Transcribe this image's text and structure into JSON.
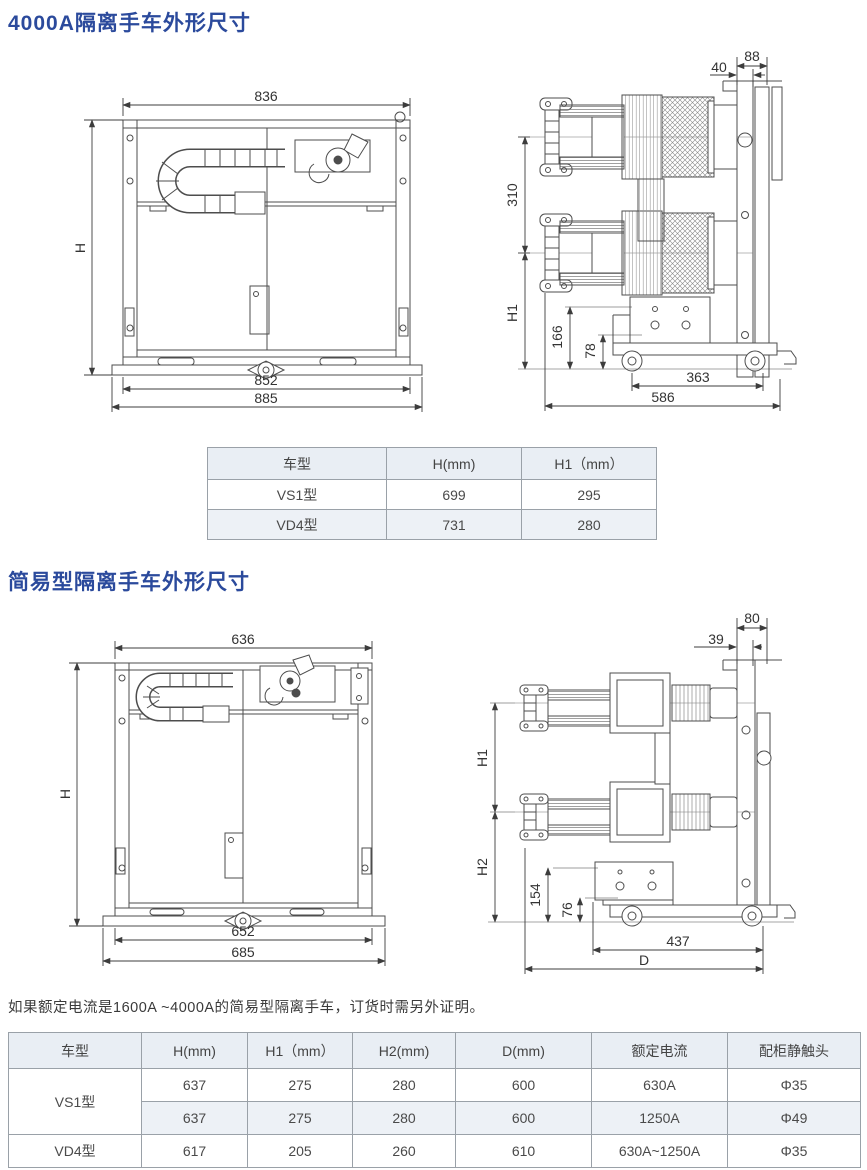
{
  "section1": {
    "title": "4000A隔离手车外形尺寸"
  },
  "section2": {
    "title": "简易型隔离手车外形尺寸"
  },
  "note": "如果额定电流是1600A ~4000A的简易型隔离手车，订货时需另外证明。",
  "fig1": {
    "top": "836",
    "left": "H",
    "b1": "852",
    "b2": "885"
  },
  "fig2": {
    "t1": "40",
    "t2": "88",
    "l1": "310",
    "l2": "H1",
    "l3": "166",
    "l4": "78",
    "b1": "363",
    "b2": "586"
  },
  "fig3": {
    "top": "636",
    "left": "H",
    "b1": "652",
    "b2": "685"
  },
  "fig4": {
    "t1": "39",
    "t2": "80",
    "l1": "H1",
    "l2": "H2",
    "l3": "154",
    "l4": "76",
    "b1": "437",
    "b2": "D"
  },
  "table1": {
    "headers": [
      "车型",
      "H(mm)",
      "H1（mm）"
    ],
    "rows": [
      [
        "VS1型",
        "699",
        "295"
      ],
      [
        "VD4型",
        "731",
        "280"
      ]
    ]
  },
  "table2": {
    "headers": [
      "车型",
      "H(mm)",
      "H1（mm）",
      "H2(mm)",
      "D(mm)",
      "额定电流",
      "配柜静触头"
    ],
    "rows": [
      [
        "VS1型",
        "637",
        "275",
        "280",
        "600",
        "630A",
        "Φ35"
      ],
      [
        "637",
        "275",
        "280",
        "600",
        "1250A",
        "Φ49"
      ],
      [
        "VD4型",
        "617",
        "205",
        "260",
        "610",
        "630A~1250A",
        "Φ35"
      ]
    ]
  },
  "colors": {
    "title_blue": "#2b4a9c",
    "table_header_bg": "#e9eef4",
    "drawing_line": "#4d4d4d"
  }
}
